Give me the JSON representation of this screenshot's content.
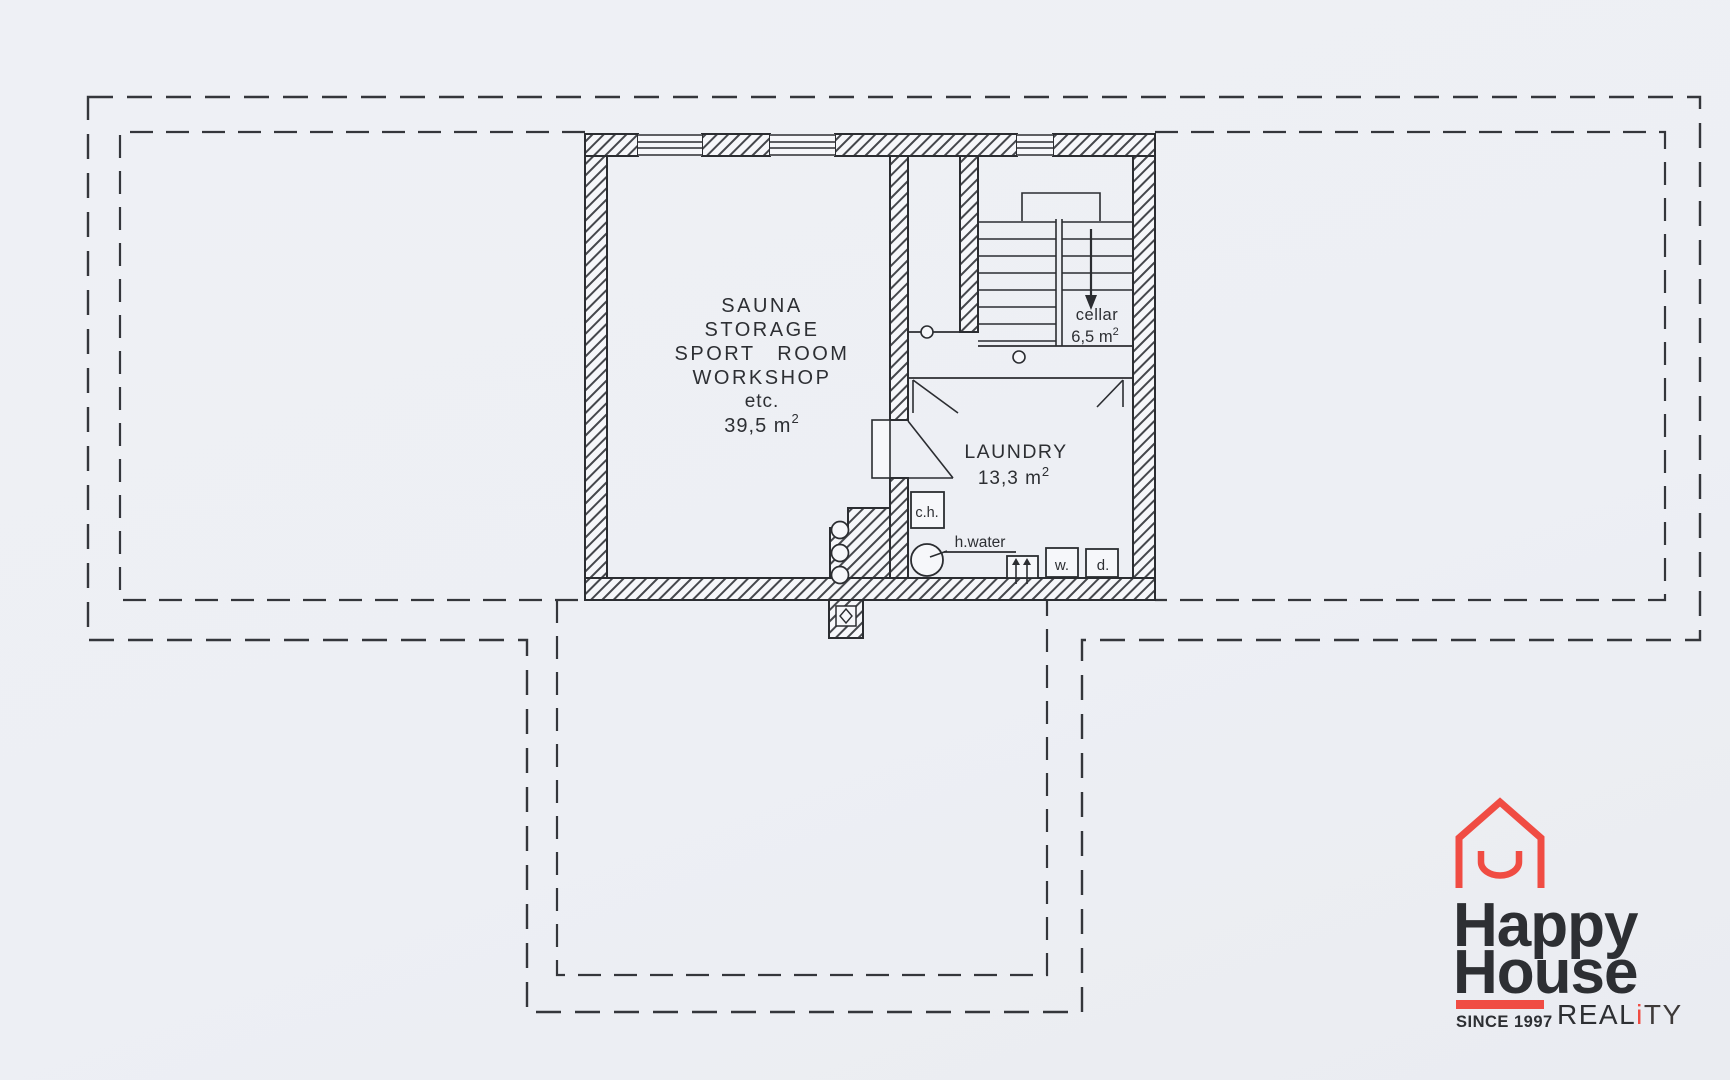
{
  "colors": {
    "paper": "#edeff4",
    "ink": "#2d2f33",
    "dash": "#34363b",
    "logo_red": "#f04c43",
    "logo_dark": "#3e3a39"
  },
  "plan": {
    "main_room": {
      "lines": [
        "SAUNA",
        "STORAGE",
        "SPORT ROOM",
        "WORKSHOP",
        "etc."
      ],
      "area_base": "39,5 m",
      "area_sup": "2"
    },
    "laundry": {
      "name": "LAUNDRY",
      "area_base": "13,3 m",
      "area_sup": "2"
    },
    "cellar": {
      "name": "cellar",
      "area_base": "6,5 m",
      "area_sup": "2"
    },
    "equipment": {
      "central_heating": "c.h.",
      "hot_water": "h.water",
      "washer": "w.",
      "dryer": "d."
    }
  },
  "logo": {
    "word1": "Happy",
    "word2": "House",
    "since": "SINCE 1997",
    "reality_pre": "REAL",
    "reality_i": "i",
    "reality_post": "TY"
  }
}
